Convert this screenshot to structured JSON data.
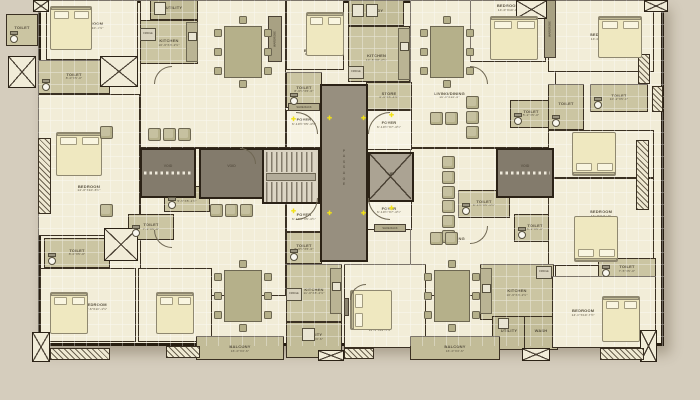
{
  "canvas": {
    "bg": "#d5cdbd",
    "wall": "#271e11",
    "tag_yellow": "#f6ec3a",
    "tag_text": "#8c2f0c",
    "marker_yellow": "#f2e215"
  },
  "core": {
    "passage": "PASSAGE",
    "up": "UP",
    "lift": "LIFT",
    "void": "VOID"
  },
  "type_tags": [
    {
      "label": "TYPE 01",
      "x": 246,
      "y": 126
    },
    {
      "label": "TYPE 02",
      "x": 414,
      "y": 126
    },
    {
      "label": "TYPE 03",
      "x": 414,
      "y": 211
    },
    {
      "label": "TYPE 04",
      "x": 246,
      "y": 211
    }
  ],
  "passage": {
    "x": 320,
    "y": 84,
    "w": 48,
    "h": 178
  },
  "stairs": {
    "x": 262,
    "y": 148,
    "w": 58,
    "h": 56
  },
  "lift": {
    "x": 368,
    "y": 152,
    "w": 46,
    "h": 50
  },
  "voids": [
    {
      "x": 140,
      "y": 148,
      "w": 56,
      "h": 50,
      "dash": true
    },
    {
      "x": 199,
      "y": 148,
      "w": 65,
      "h": 51,
      "dash": false
    },
    {
      "x": 496,
      "y": 148,
      "w": 58,
      "h": 50,
      "dash": true
    }
  ],
  "markers": [
    [
      327,
      116
    ],
    [
      361,
      116
    ],
    [
      327,
      211
    ],
    [
      361,
      211
    ],
    [
      291,
      117
    ],
    [
      389,
      113
    ],
    [
      291,
      209
    ],
    [
      389,
      206
    ]
  ],
  "rooms": [
    {
      "l": "LIVING/DINING",
      "d": "21'-4\"X10'-7½\"",
      "x": 140,
      "y": 0,
      "w": 146,
      "h": 148,
      "f": "cream",
      "lx": 70,
      "lt": 50
    },
    {
      "l": "LIVING/DINING",
      "d": "21'-4\"X10'-7½\"",
      "x": 140,
      "y": 148,
      "w": 146,
      "h": 148,
      "f": "cream",
      "lx": 70,
      "lt": 30
    },
    {
      "l": "LIVING/DINING",
      "d": "16'-9\"X10'-0\"",
      "x": 410,
      "y": 0,
      "w": 146,
      "h": 148,
      "f": "cream",
      "lx": 27,
      "lt": 64
    },
    {
      "l": "LIVING/DINING",
      "d": "16'-9\"X10'-0\"",
      "x": 410,
      "y": 148,
      "w": 146,
      "h": 148,
      "f": "cream",
      "lx": 27,
      "lt": 62
    },
    {
      "l": "BEDROOM",
      "d": "10'-6\"X10'-1½\"",
      "x": 46,
      "y": 0,
      "w": 92,
      "h": 60,
      "f": "cream",
      "lx": 50,
      "lt": 42
    },
    {
      "l": "TOILET",
      "d": "8'-0\"X5'-0\"",
      "x": 38,
      "y": 60,
      "w": 72,
      "h": 34,
      "f": "khaki"
    },
    {
      "l": "BEDROOM",
      "d": "14'-0\"X10'-6½\"",
      "x": 38,
      "y": 94,
      "w": 102,
      "h": 142,
      "f": "cream",
      "lx": 50,
      "lt": 66
    },
    {
      "l": "TOILET",
      "d": "",
      "x": 6,
      "y": 14,
      "w": 32,
      "h": 32,
      "f": "khaki"
    },
    {
      "l": "UTILITY",
      "d": "",
      "x": 150,
      "y": 0,
      "w": 48,
      "h": 20,
      "f": "khaki2"
    },
    {
      "l": "KITCHEN",
      "d": "10'-6\"X8'-2½\"",
      "x": 140,
      "y": 20,
      "w": 58,
      "h": 44,
      "f": "khaki",
      "lx": 50,
      "lt": 50
    },
    {
      "l": "BEDROOM",
      "d": "11'-2\"X10'-2\"",
      "x": 286,
      "y": 0,
      "w": 58,
      "h": 70,
      "f": "cream",
      "lx": 50,
      "lt": 74
    },
    {
      "l": "TOILET",
      "d": "8'-6½\"X5'-0\"",
      "x": 286,
      "y": 72,
      "w": 36,
      "h": 36,
      "f": "khaki"
    },
    {
      "l": "FOYER",
      "d": "6'-10½\"X5'-4½\"",
      "x": 286,
      "y": 110,
      "w": 36,
      "h": 38,
      "f": "pale",
      "lx": 50,
      "lt": 30
    },
    {
      "l": "FOYER",
      "d": "6'-10½\"X5'-4½\"",
      "x": 286,
      "y": 196,
      "w": 36,
      "h": 36,
      "f": "pale",
      "lx": 50,
      "lt": 56
    },
    {
      "l": "TOILET",
      "d": "8'-6½\"X5'-0\"",
      "x": 286,
      "y": 232,
      "w": 36,
      "h": 32,
      "f": "khaki"
    },
    {
      "l": "KITCHEN",
      "d": "11'-0\"X8'-2½\"",
      "x": 286,
      "y": 264,
      "w": 56,
      "h": 58,
      "f": "khaki",
      "lx": 50,
      "lt": 46
    },
    {
      "l": "UTILITY",
      "d": "11'-0\"X3'-6\"",
      "x": 286,
      "y": 322,
      "w": 56,
      "h": 36,
      "f": "khaki2",
      "lx": 50,
      "lt": 40
    },
    {
      "l": "BEDROOM",
      "d": "11'-6\"X11'-1½\"",
      "x": 344,
      "y": 264,
      "w": 82,
      "h": 84,
      "f": "cream",
      "lx": 44,
      "lt": 76
    },
    {
      "l": "TOILET",
      "d": "5'-5\"X5'-1½\"",
      "x": 164,
      "y": 186,
      "w": 46,
      "h": 26,
      "f": "khaki"
    },
    {
      "l": "TOILET",
      "d": "7'-2\"X5'-0\"",
      "x": 128,
      "y": 214,
      "w": 46,
      "h": 26,
      "f": "khaki"
    },
    {
      "l": "TOILET",
      "d": "8'-0\"X5'-0\"",
      "x": 44,
      "y": 238,
      "w": 66,
      "h": 30,
      "f": "khaki"
    },
    {
      "l": "BEDROOM",
      "d": "10'-6\"X10'-1½\"",
      "x": 40,
      "y": 268,
      "w": 96,
      "h": 74,
      "f": "cream",
      "lx": 58,
      "lt": 52
    },
    {
      "l": "BEDROOM",
      "d": "10'-6\"X10'-0\"",
      "x": 138,
      "y": 268,
      "w": 74,
      "h": 74,
      "f": "cream",
      "lx": 48,
      "lt": 82
    },
    {
      "l": "STUDY",
      "d": "",
      "x": 348,
      "y": 0,
      "w": 56,
      "h": 26,
      "f": "khaki2"
    },
    {
      "l": "KITCHEN",
      "d": "10'-6\"X8'-2½\"",
      "x": 348,
      "y": 26,
      "w": 62,
      "h": 56,
      "f": "khaki",
      "lx": 46,
      "lt": 56
    },
    {
      "l": "STORE",
      "d": "6'-6\"X5'-4½\"",
      "x": 366,
      "y": 82,
      "w": 46,
      "h": 28,
      "f": "khaki"
    },
    {
      "l": "FOYER",
      "d": "6'-10½\"X7'-4½\"",
      "x": 366,
      "y": 110,
      "w": 46,
      "h": 40,
      "f": "pale",
      "lx": 50,
      "lt": 36
    },
    {
      "l": "BEDROOM",
      "d": "14'-0\"X10'-0\"",
      "x": 470,
      "y": 0,
      "w": 76,
      "h": 62,
      "f": "cream",
      "lx": 50,
      "lt": 12
    },
    {
      "l": "BEDROOM",
      "d": "14'-0\"X10'-6\"",
      "x": 548,
      "y": 0,
      "w": 106,
      "h": 72,
      "f": "cream",
      "lx": 50,
      "lt": 50
    },
    {
      "l": "TOILET",
      "d": "5'-2\"X5'-0\"",
      "x": 510,
      "y": 100,
      "w": 42,
      "h": 28,
      "f": "khaki"
    },
    {
      "l": "TOILET",
      "d": "",
      "x": 548,
      "y": 84,
      "w": 36,
      "h": 46,
      "f": "khaki"
    },
    {
      "l": "TOILET",
      "d": "10'-2\"X5'-0\"",
      "x": 590,
      "y": 84,
      "w": 58,
      "h": 28,
      "f": "khaki"
    },
    {
      "l": "BEDROOM",
      "d": "14'-0\"X10'-0\"",
      "x": 548,
      "y": 130,
      "w": 106,
      "h": 48,
      "f": "cream",
      "lx": 50,
      "lt": 12
    },
    {
      "l": "FOYER",
      "d": "6'-10½\"X7'-4½\"",
      "x": 366,
      "y": 196,
      "w": 46,
      "h": 34,
      "f": "pale",
      "lx": 50,
      "lt": 40
    },
    {
      "l": "TOILET",
      "d": "8'-1½\"X5'-1½\"",
      "x": 458,
      "y": 190,
      "w": 52,
      "h": 28,
      "f": "khaki"
    },
    {
      "l": "TOILET",
      "d": "5'-2\"X5'-0\"",
      "x": 514,
      "y": 214,
      "w": 42,
      "h": 28,
      "f": "khaki"
    },
    {
      "l": "BEDROOM",
      "d": "14'-0\"X11'-0\"",
      "x": 548,
      "y": 178,
      "w": 106,
      "h": 88,
      "f": "cream",
      "lx": 50,
      "lt": 40
    },
    {
      "l": "KITCHEN",
      "d": "10'-6\"X8'-2½\"",
      "x": 480,
      "y": 264,
      "w": 74,
      "h": 56,
      "f": "khaki",
      "lx": 50,
      "lt": 50
    },
    {
      "l": "UTILITY",
      "d": "",
      "x": 492,
      "y": 316,
      "w": 34,
      "h": 34,
      "f": "khaki2",
      "lx": 50,
      "lt": 46
    },
    {
      "l": "WASH",
      "d": "",
      "x": 524,
      "y": 316,
      "w": 34,
      "h": 34,
      "f": "khaki2",
      "lx": 50,
      "lt": 46
    },
    {
      "l": "TOILET",
      "d": "7'-5\"X5'-0\"",
      "x": 598,
      "y": 258,
      "w": 58,
      "h": 22,
      "f": "khaki"
    },
    {
      "l": "BEDROOM",
      "d": "14'-0\"X10'-7½\"",
      "x": 552,
      "y": 276,
      "w": 104,
      "h": 72,
      "f": "cream",
      "lx": 30,
      "lt": 50
    },
    {
      "l": "BALCONY",
      "d": "16'-0\"X3'-6\"",
      "x": 196,
      "y": 336,
      "w": 88,
      "h": 24,
      "f": "khaki2",
      "lx": 50,
      "lt": 50
    },
    {
      "l": "BALCONY",
      "d": "16'-0\"X3'-6\"",
      "x": 410,
      "y": 336,
      "w": 90,
      "h": 24,
      "f": "khaki2",
      "lx": 50,
      "lt": 50
    }
  ],
  "wardrobes": [
    {
      "x": 268,
      "y": 16,
      "w": 14,
      "h": 46,
      "label": "WARDROBE"
    },
    {
      "x": 544,
      "y": 0,
      "w": 12,
      "h": 58,
      "label": "WARDROBE"
    }
  ],
  "shoe_racks": [
    {
      "x": 288,
      "y": 103,
      "w": 32,
      "h": 8,
      "label": "SHOE RACK"
    },
    {
      "x": 374,
      "y": 224,
      "w": 32,
      "h": 8,
      "label": "SHOE RACK"
    }
  ],
  "fridges": [
    {
      "x": 140,
      "y": 28,
      "label": "FRIDGE"
    },
    {
      "x": 348,
      "y": 66,
      "label": "FRIDGE"
    },
    {
      "x": 286,
      "y": 288,
      "label": "FRIDGE"
    },
    {
      "x": 536,
      "y": 266,
      "label": "FRIDGE"
    }
  ],
  "ducts": [
    [
      8,
      56,
      28,
      32
    ],
    [
      33,
      0,
      16,
      12
    ],
    [
      644,
      0,
      24,
      12
    ],
    [
      32,
      332,
      18,
      30
    ],
    [
      318,
      350,
      26,
      11
    ],
    [
      522,
      348,
      28,
      13
    ],
    [
      640,
      330,
      17,
      32
    ],
    [
      516,
      0,
      31,
      19
    ],
    [
      100,
      56,
      38,
      31
    ],
    [
      104,
      228,
      34,
      33
    ]
  ],
  "hatches": [
    [
      38,
      138,
      13,
      76,
      "v"
    ],
    [
      636,
      140,
      13,
      70,
      "v"
    ],
    [
      50,
      348,
      60,
      12,
      "h"
    ],
    [
      166,
      346,
      34,
      12,
      "h"
    ],
    [
      344,
      348,
      30,
      11,
      "h"
    ],
    [
      600,
      348,
      44,
      12,
      "h"
    ],
    [
      638,
      54,
      12,
      30,
      "v"
    ],
    [
      652,
      86,
      11,
      26,
      "v"
    ]
  ],
  "beds": [
    [
      50,
      6,
      42,
      44,
      "t"
    ],
    [
      56,
      132,
      46,
      44,
      "t"
    ],
    [
      306,
      12,
      38,
      44,
      "t"
    ],
    [
      490,
      16,
      48,
      44,
      "t"
    ],
    [
      598,
      16,
      44,
      42,
      "t"
    ],
    [
      572,
      132,
      44,
      44,
      "b"
    ],
    [
      574,
      216,
      44,
      46,
      "b"
    ],
    [
      602,
      296,
      38,
      46,
      "t"
    ],
    [
      50,
      292,
      38,
      42,
      "t"
    ],
    [
      156,
      292,
      38,
      42,
      "t"
    ],
    [
      350,
      290,
      42,
      40,
      "l"
    ]
  ],
  "tables": [
    [
      224,
      26,
      38,
      52
    ],
    [
      430,
      26,
      34,
      52
    ],
    [
      224,
      270,
      38,
      52
    ],
    [
      434,
      270,
      36,
      52
    ]
  ],
  "sofas": [
    {
      "x": 148,
      "y": 128,
      "n": 3,
      "dir": "h"
    },
    {
      "x": 210,
      "y": 204,
      "n": 3,
      "dir": "h"
    },
    {
      "x": 466,
      "y": 96,
      "n": 3,
      "dir": "v"
    },
    {
      "x": 442,
      "y": 156,
      "n": 3,
      "dir": "v"
    },
    {
      "x": 442,
      "y": 200,
      "n": 3,
      "dir": "v"
    },
    {
      "x": 430,
      "y": 112,
      "n": 2,
      "dir": "h"
    },
    {
      "x": 430,
      "y": 232,
      "n": 2,
      "dir": "h"
    },
    {
      "x": 100,
      "y": 126,
      "n": 1,
      "dir": "h"
    },
    {
      "x": 100,
      "y": 204,
      "n": 1,
      "dir": "h"
    }
  ],
  "counters": [
    [
      186,
      22,
      12,
      40
    ],
    [
      398,
      28,
      12,
      52
    ],
    [
      330,
      268,
      12,
      46
    ],
    [
      480,
      268,
      12,
      46
    ]
  ],
  "appliances": [
    [
      188,
      32,
      9,
      9
    ],
    [
      400,
      42,
      9,
      9
    ],
    [
      332,
      282,
      9,
      9
    ],
    [
      482,
      284,
      9,
      9
    ],
    [
      352,
      4,
      12,
      13
    ],
    [
      366,
      4,
      12,
      13
    ],
    [
      154,
      2,
      12,
      13
    ],
    [
      302,
      328,
      13,
      13
    ],
    [
      498,
      318,
      11,
      11
    ]
  ],
  "tvs": [
    [
      344,
      298,
      5,
      18
    ]
  ],
  "arcs": [
    [
      296,
      112,
      22,
      1
    ],
    [
      368,
      112,
      22,
      0
    ],
    [
      296,
      198,
      22,
      2
    ],
    [
      368,
      198,
      22,
      3
    ],
    [
      154,
      66,
      18,
      0
    ],
    [
      470,
      66,
      18,
      1
    ],
    [
      154,
      230,
      18,
      3
    ],
    [
      470,
      226,
      18,
      2
    ],
    [
      350,
      284,
      16,
      0
    ],
    [
      240,
      148,
      16,
      1
    ]
  ]
}
